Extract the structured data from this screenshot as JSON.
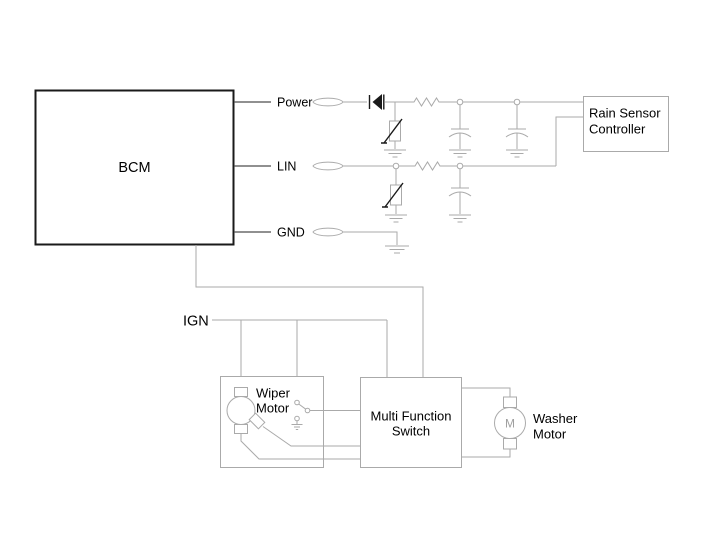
{
  "diagram": {
    "type": "automotive-wiring-diagram",
    "background": "#ffffff",
    "wire_color": "#aaaaaa",
    "bcm_border_color": "#1a1a1a",
    "text_color": "#000000",
    "blocks": {
      "bcm": {
        "label": "BCM"
      },
      "rain_sensor_controller": {
        "label_line1": "Rain Sensor",
        "label_line2": "Controller"
      },
      "wiper_motor": {
        "label_line1": "Wiper",
        "label_line2": "Motor"
      },
      "multi_function_switch": {
        "label_line1": "Multi Function",
        "label_line2": "Switch"
      },
      "washer_motor": {
        "label_line1": "Washer",
        "label_line2": "Motor",
        "motor_letter": "M"
      }
    },
    "signals": {
      "power": "Power",
      "lin": "LIN",
      "gnd": "GND",
      "ign": "IGN"
    },
    "symbols": [
      "connector-oval",
      "filter-capacitor",
      "varistor",
      "resistor",
      "capacitor",
      "ground",
      "junction-dot",
      "motor",
      "park-switch"
    ]
  }
}
